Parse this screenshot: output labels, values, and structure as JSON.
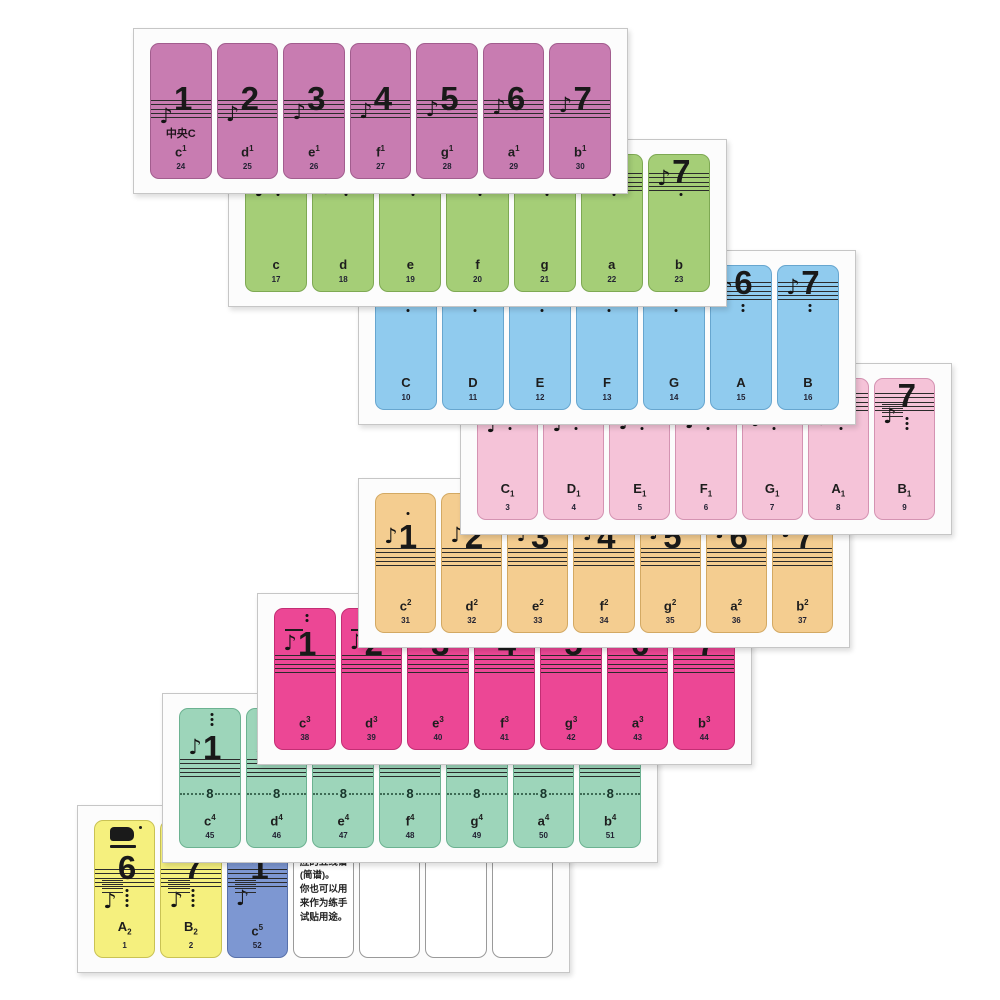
{
  "product": {
    "kind": "piano-keyboard-note-sticker-sheets"
  },
  "icons": {
    "eighth_note": "♪"
  },
  "sheets": [
    {
      "name": "octave-one-lined",
      "color": "#c87cb1",
      "border": "#a25d8e",
      "dots": 0,
      "dots_position": "below",
      "stickers": [
        {
          "type": "note",
          "num": "1",
          "middle_c_label": "中央C",
          "note": "c",
          "script": "1",
          "script_pos": "sup",
          "key": "24"
        },
        {
          "type": "note",
          "num": "2",
          "note": "d",
          "script": "1",
          "script_pos": "sup",
          "key": "25"
        },
        {
          "type": "note",
          "num": "3",
          "note": "e",
          "script": "1",
          "script_pos": "sup",
          "key": "26"
        },
        {
          "type": "note",
          "num": "4",
          "note": "f",
          "script": "1",
          "script_pos": "sup",
          "key": "27"
        },
        {
          "type": "note",
          "num": "5",
          "note": "g",
          "script": "1",
          "script_pos": "sup",
          "key": "28"
        },
        {
          "type": "note",
          "num": "6",
          "note": "a",
          "script": "1",
          "script_pos": "sup",
          "key": "29"
        },
        {
          "type": "note",
          "num": "7",
          "note": "b",
          "script": "1",
          "script_pos": "sup",
          "key": "30"
        }
      ]
    },
    {
      "name": "octave-small",
      "color": "#a5ce77",
      "border": "#7ea953",
      "dots": 1,
      "dots_position": "below",
      "stickers": [
        {
          "type": "note",
          "num": "1",
          "note": "c",
          "script": "",
          "script_pos": "sup",
          "key": "17"
        },
        {
          "type": "note",
          "num": "2",
          "note": "d",
          "script": "",
          "script_pos": "sup",
          "key": "18"
        },
        {
          "type": "note",
          "num": "3",
          "note": "e",
          "script": "",
          "script_pos": "sup",
          "key": "19"
        },
        {
          "type": "note",
          "num": "4",
          "note": "f",
          "script": "",
          "script_pos": "sup",
          "key": "20"
        },
        {
          "type": "note",
          "num": "5",
          "note": "g",
          "script": "",
          "script_pos": "sup",
          "key": "21"
        },
        {
          "type": "note",
          "num": "6",
          "note": "a",
          "script": "",
          "script_pos": "sup",
          "key": "22"
        },
        {
          "type": "note",
          "num": "7",
          "note": "b",
          "script": "",
          "script_pos": "sup",
          "key": "23"
        }
      ]
    },
    {
      "name": "octave-great",
      "color": "#90cbee",
      "border": "#67a6cf",
      "dots": 2,
      "dots_position": "below",
      "stickers": [
        {
          "type": "note",
          "num": "1",
          "note": "C",
          "script": "",
          "script_pos": "sup",
          "key": "10"
        },
        {
          "type": "note",
          "num": "2",
          "note": "D",
          "script": "",
          "script_pos": "sup",
          "key": "11"
        },
        {
          "type": "note",
          "num": "3",
          "note": "E",
          "script": "",
          "script_pos": "sup",
          "key": "12"
        },
        {
          "type": "note",
          "num": "4",
          "note": "F",
          "script": "",
          "script_pos": "sup",
          "key": "13"
        },
        {
          "type": "note",
          "num": "5",
          "note": "G",
          "script": "",
          "script_pos": "sup",
          "key": "14"
        },
        {
          "type": "note",
          "num": "6",
          "note": "A",
          "script": "",
          "script_pos": "sup",
          "key": "15"
        },
        {
          "type": "note",
          "num": "7",
          "note": "B",
          "script": "",
          "script_pos": "sup",
          "key": "16"
        }
      ]
    },
    {
      "name": "octave-contra",
      "color": "#f5c3d8",
      "border": "#d493b2",
      "dots": 3,
      "dots_position": "below",
      "stickers": [
        {
          "type": "note",
          "num": "1",
          "note": "C",
          "script": "1",
          "script_pos": "sub",
          "key": "3"
        },
        {
          "type": "note",
          "num": "2",
          "note": "D",
          "script": "1",
          "script_pos": "sub",
          "key": "4"
        },
        {
          "type": "note",
          "num": "3",
          "note": "E",
          "script": "1",
          "script_pos": "sub",
          "key": "5"
        },
        {
          "type": "note",
          "num": "4",
          "note": "F",
          "script": "1",
          "script_pos": "sub",
          "key": "6"
        },
        {
          "type": "note",
          "num": "5",
          "note": "G",
          "script": "1",
          "script_pos": "sub",
          "key": "7"
        },
        {
          "type": "note",
          "num": "6",
          "note": "A",
          "script": "1",
          "script_pos": "sub",
          "key": "8"
        },
        {
          "type": "note",
          "num": "7",
          "note": "B",
          "script": "1",
          "script_pos": "sub",
          "key": "9"
        }
      ]
    },
    {
      "name": "octave-two-lined",
      "color": "#f4cd90",
      "border": "#d3a963",
      "dots": 1,
      "dots_position": "above",
      "stickers": [
        {
          "type": "note",
          "num": "1",
          "note": "c",
          "script": "2",
          "script_pos": "sup",
          "key": "31"
        },
        {
          "type": "note",
          "num": "2",
          "note": "d",
          "script": "2",
          "script_pos": "sup",
          "key": "32"
        },
        {
          "type": "note",
          "num": "3",
          "note": "e",
          "script": "2",
          "script_pos": "sup",
          "key": "33"
        },
        {
          "type": "note",
          "num": "4",
          "note": "f",
          "script": "2",
          "script_pos": "sup",
          "key": "34"
        },
        {
          "type": "note",
          "num": "5",
          "note": "g",
          "script": "2",
          "script_pos": "sup",
          "key": "35"
        },
        {
          "type": "note",
          "num": "6",
          "note": "a",
          "script": "2",
          "script_pos": "sup",
          "key": "36"
        },
        {
          "type": "note",
          "num": "7",
          "note": "b",
          "script": "2",
          "script_pos": "sup",
          "key": "37"
        }
      ]
    },
    {
      "name": "octave-three-lined",
      "color": "#ec4795",
      "border": "#c32e74",
      "dots": 2,
      "dots_position": "above",
      "stickers": [
        {
          "type": "note",
          "num": "1",
          "note": "c",
          "script": "3",
          "script_pos": "sup",
          "key": "38"
        },
        {
          "type": "note",
          "num": "2",
          "note": "d",
          "script": "3",
          "script_pos": "sup",
          "key": "39"
        },
        {
          "type": "note",
          "num": "3",
          "note": "e",
          "script": "3",
          "script_pos": "sup",
          "key": "40"
        },
        {
          "type": "note",
          "num": "4",
          "note": "f",
          "script": "3",
          "script_pos": "sup",
          "key": "41"
        },
        {
          "type": "note",
          "num": "5",
          "note": "g",
          "script": "3",
          "script_pos": "sup",
          "key": "42"
        },
        {
          "type": "note",
          "num": "6",
          "note": "a",
          "script": "3",
          "script_pos": "sup",
          "key": "43"
        },
        {
          "type": "note",
          "num": "7",
          "note": "b",
          "script": "3",
          "script_pos": "sup",
          "key": "44"
        }
      ]
    },
    {
      "name": "octave-four-lined",
      "color": "#9dd5ba",
      "border": "#6cb291",
      "dots": 3,
      "dots_position": "above",
      "ottava_label": "8",
      "stickers": [
        {
          "type": "note",
          "num": "1",
          "note": "c",
          "script": "4",
          "script_pos": "sup",
          "key": "45"
        },
        {
          "type": "note",
          "num": "2",
          "note": "d",
          "script": "4",
          "script_pos": "sup",
          "key": "46"
        },
        {
          "type": "note",
          "num": "3",
          "note": "e",
          "script": "4",
          "script_pos": "sup",
          "key": "47"
        },
        {
          "type": "note",
          "num": "4",
          "note": "f",
          "script": "4",
          "script_pos": "sup",
          "key": "48"
        },
        {
          "type": "note",
          "num": "5",
          "note": "g",
          "script": "4",
          "script_pos": "sup",
          "key": "49"
        },
        {
          "type": "note",
          "num": "6",
          "note": "a",
          "script": "4",
          "script_pos": "sup",
          "key": "50"
        },
        {
          "type": "note",
          "num": "7",
          "note": "b",
          "script": "4",
          "script_pos": "sup",
          "key": "51"
        }
      ]
    },
    {
      "name": "edges-and-blanks",
      "color": "#ffffff",
      "border": "#9a9a9a",
      "dots": 0,
      "dots_position": "below",
      "stickers": [
        {
          "type": "note",
          "num": "6",
          "note": "A",
          "script": "2",
          "script_pos": "sub",
          "key": "1",
          "color": "#f5f07e",
          "border": "#c9c254",
          "dots": 4,
          "dots_position": "below",
          "brand_logo": true
        },
        {
          "type": "note",
          "num": "7",
          "note": "B",
          "script": "2",
          "script_pos": "sub",
          "key": "2",
          "color": "#f5f07e",
          "border": "#c9c254",
          "dots": 4,
          "dots_position": "below"
        },
        {
          "type": "note",
          "num": "1",
          "note": "c",
          "script": "5",
          "script_pos": "sup",
          "key": "52",
          "color": "#7d97d2",
          "border": "#5871ab",
          "dots": 0,
          "overline": true
        },
        {
          "type": "text",
          "lines": [
            "贴(需要用油",
            "性笔写上对",
            "应的五线谱",
            "(简谱)。",
            "你也可以用",
            "来作为练手",
            "试贴用途。"
          ]
        },
        {
          "type": "blank"
        },
        {
          "type": "blank"
        },
        {
          "type": "blank"
        }
      ]
    }
  ]
}
